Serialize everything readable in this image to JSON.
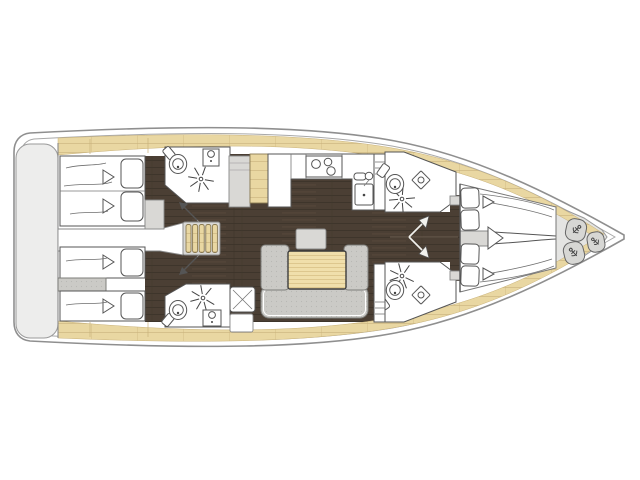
{
  "diagram": {
    "type": "sailing-yacht-interior-floor-plan",
    "orientation": "bow-right-stern-left",
    "colors": {
      "background": "#ffffff",
      "hull_outline": "#8f8f8f",
      "hull_inner_line": "#a8a8a8",
      "deck_wood": "#e9d7a2",
      "deck_wood_line": "#c9b27a",
      "floor_dark": "#4b3f34",
      "floor_dark_line": "#3e352b",
      "platform_gray": "#ededec",
      "furniture_gray": "#d9d8d5",
      "sofa_gray": "#cbcac6",
      "sofa_dot": "#b9b8b4",
      "fixture_outline": "#555555",
      "table_wood": "#f0dfab",
      "table_wood_line": "#ddc78e",
      "bow_locker_gray": "#e4e4e2",
      "fender_gray": "#d7d7d4",
      "door_symbol_dark": "#555555",
      "door_symbol_light": "#f2f2ee"
    },
    "areas": [
      {
        "id": "swim_platform",
        "label": "stern swim platform"
      },
      {
        "id": "aft_cabin_port",
        "label": "aft double cabin",
        "beds": 1,
        "pillows": 2
      },
      {
        "id": "aft_cabin_starboard",
        "label": "aft twin cabin",
        "beds": 2,
        "pillows": 2
      },
      {
        "id": "aft_head_port",
        "label": "aft head with shower",
        "fixtures": [
          "toilet",
          "washbasin",
          "shower"
        ]
      },
      {
        "id": "aft_head_starboard",
        "label": "aft head with shower",
        "fixtures": [
          "toilet",
          "washbasin",
          "shower"
        ]
      },
      {
        "id": "companionway",
        "label": "companionway stairs",
        "steps": 5
      },
      {
        "id": "galley",
        "label": "galley",
        "fixtures": [
          "three-burner-stove",
          "sink",
          "fridge",
          "cabinet"
        ]
      },
      {
        "id": "salon",
        "label": "salon",
        "fixtures": [
          "u-shaped-sofa",
          "folding-table",
          "seat"
        ]
      },
      {
        "id": "fwd_head_port",
        "label": "forward head",
        "fixtures": [
          "toilet",
          "washbasin",
          "shower"
        ]
      },
      {
        "id": "fwd_head_starboard",
        "label": "forward head",
        "fixtures": [
          "toilet",
          "washbasin",
          "shower"
        ]
      },
      {
        "id": "forward_cabin",
        "label": "forward V-berth cabin",
        "beds": 2,
        "pillows": 4
      },
      {
        "id": "bow_locker",
        "label": "bow locker",
        "fenders": 3
      }
    ]
  }
}
